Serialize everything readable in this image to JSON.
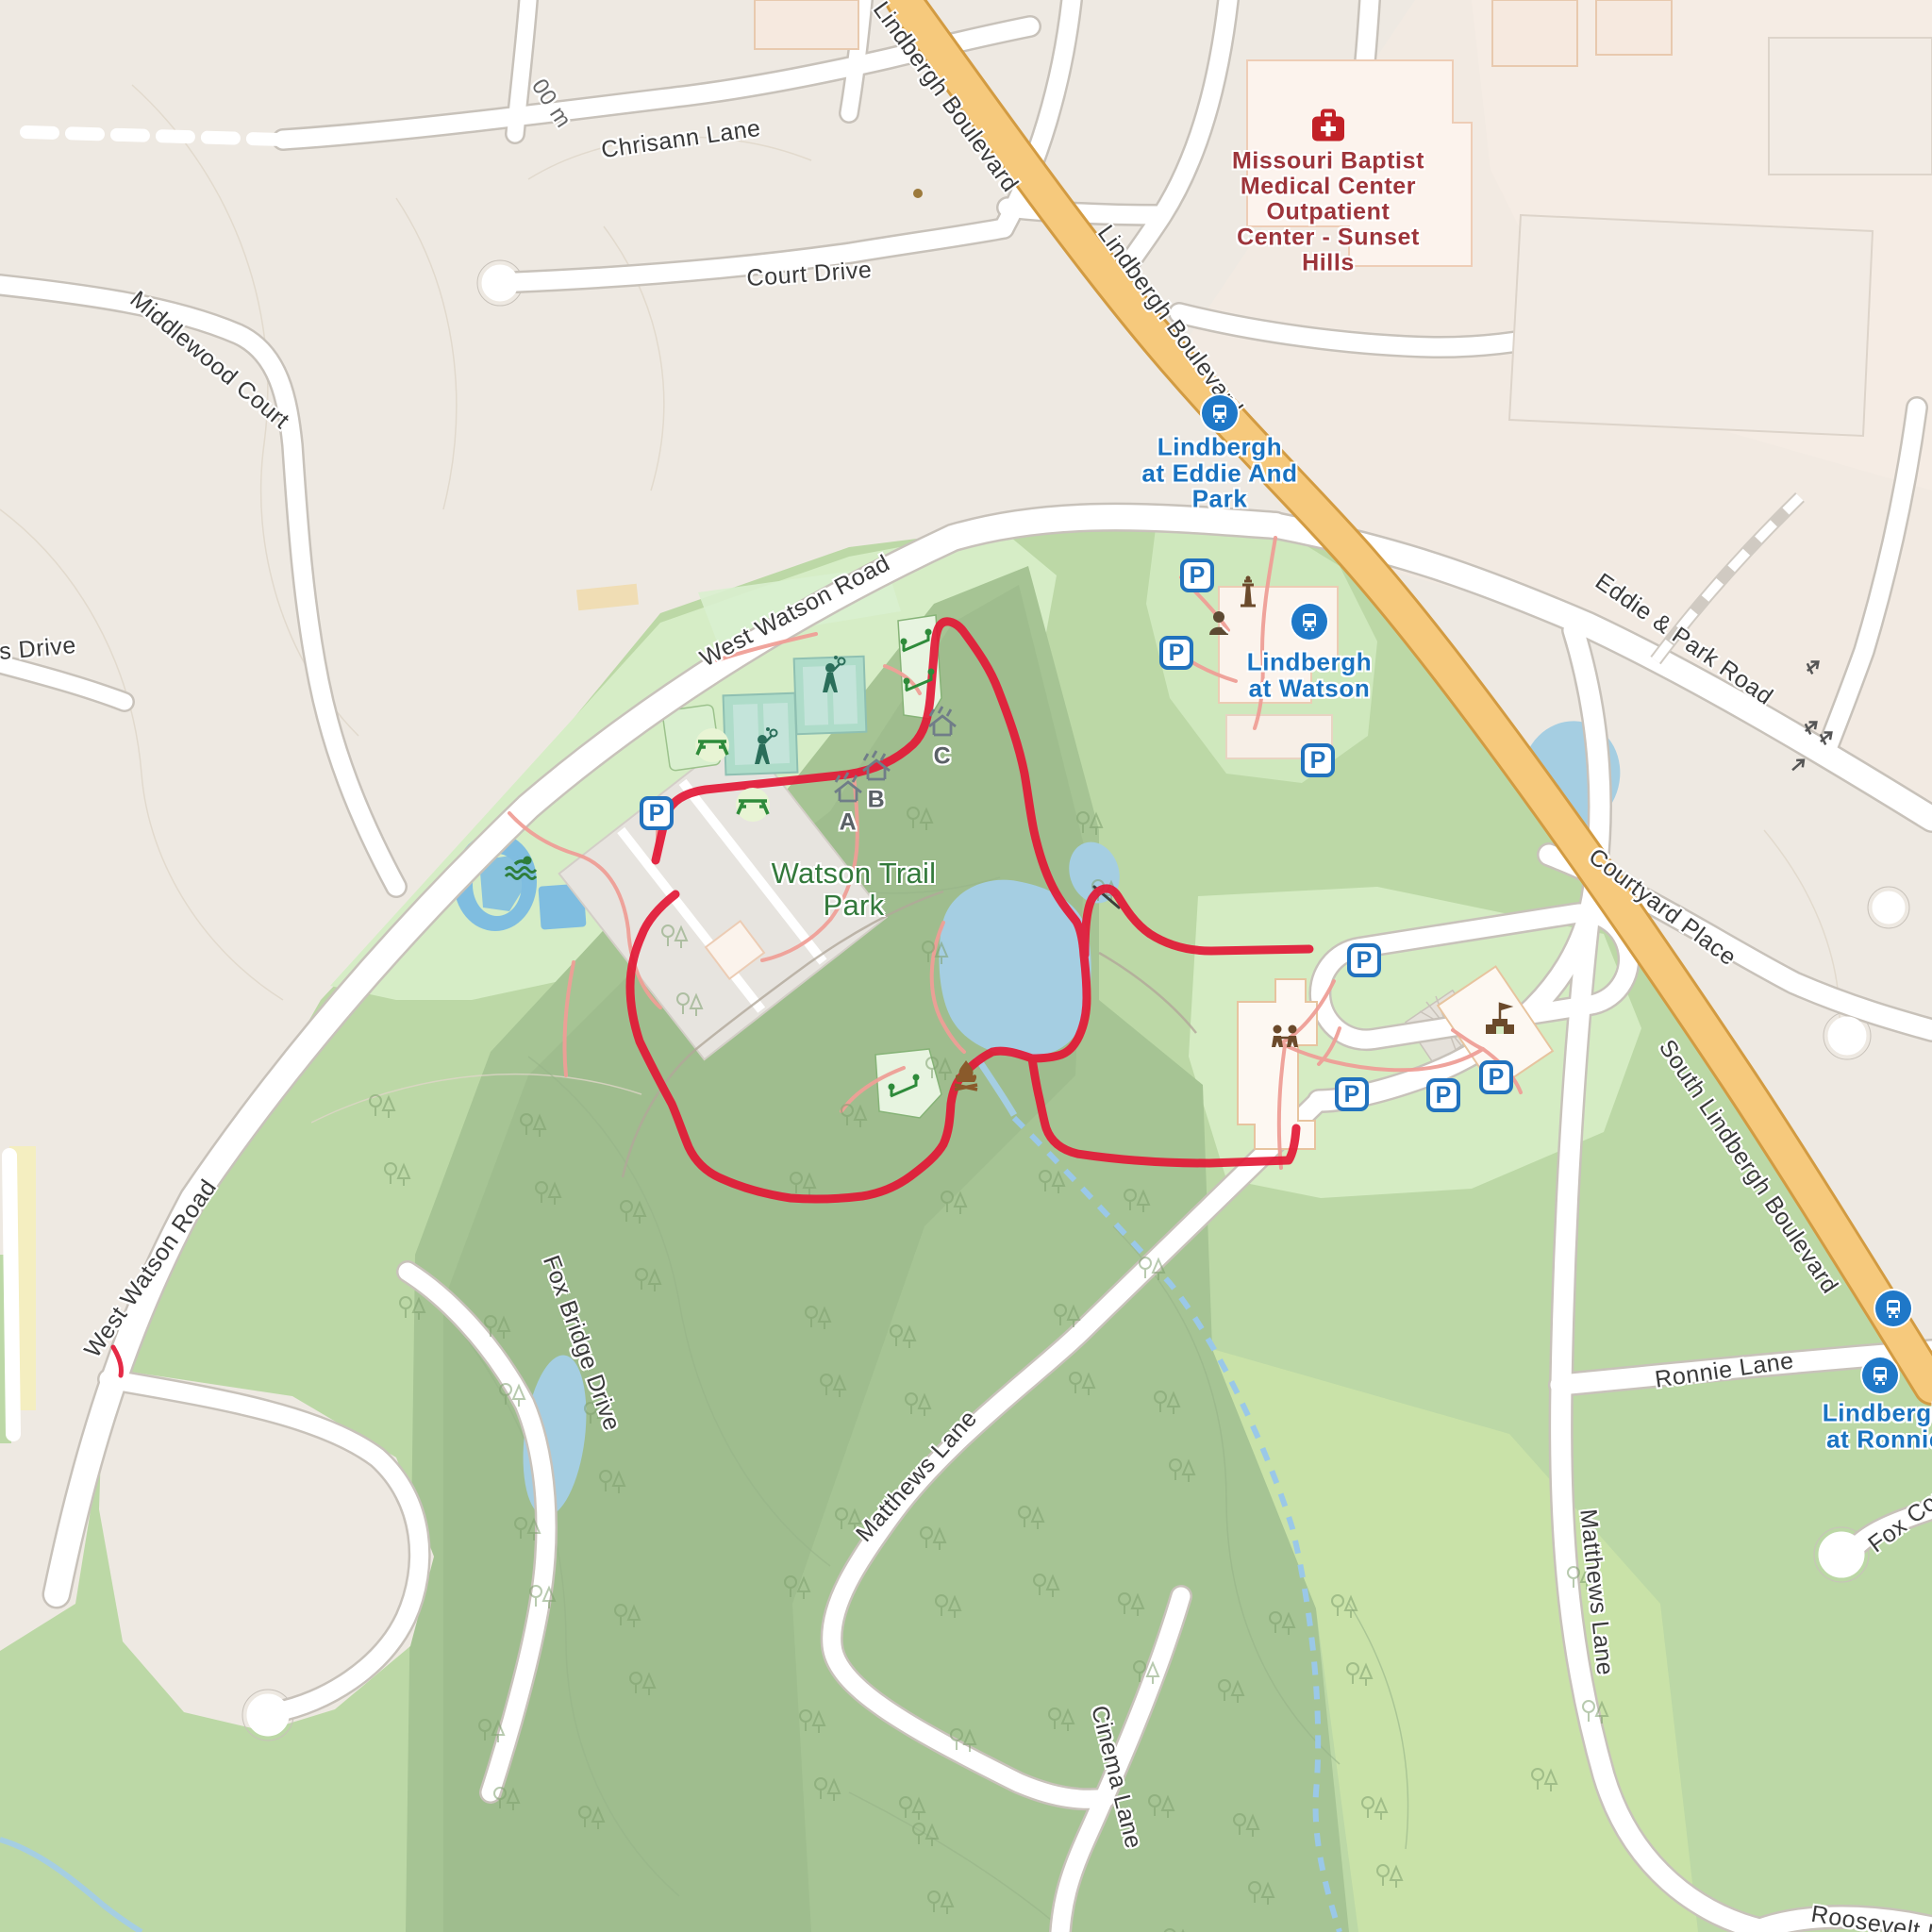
{
  "map_title": "Watson Trail Park area map",
  "road_labels": {
    "chrisann": "Chrisann Lane",
    "court_drive": "Court Drive",
    "middlewood": "Middlewood Court",
    "scale_partial": "00 m",
    "lindbergh_a": "Lindbergh Boulevard",
    "lindbergh_b": "Lindbergh Boulevard",
    "west_watson_a": "West Watson Road",
    "west_watson_b": "West Watson Road",
    "eddie_park": "Eddie & Park Road",
    "courtyard": "Courtyard Place",
    "south_lindbergh": "South Lindbergh Boulevard",
    "ronnie": "Ronnie Lane",
    "fox_bridge": "Fox Bridge Drive",
    "matthews_a": "Matthews Lane",
    "matthews_b": "Matthews Lane",
    "cinema": "Cinema Lane",
    "fox_court": "Fox Court",
    "roosevelt": "Roosevelt Dr",
    "s_drive": "s Drive"
  },
  "pois": {
    "park": {
      "lines": [
        "Watson Trail",
        "Park"
      ]
    },
    "hospital": {
      "lines": [
        "Missouri Baptist",
        "Medical Center",
        "Outpatient",
        "Center - Sunset",
        "Hills"
      ]
    }
  },
  "transit_stops": {
    "eddie": {
      "lines": [
        "Lindbergh",
        "at Eddie And",
        "Park"
      ]
    },
    "watson": {
      "lines": [
        "Lindbergh",
        "at Watson"
      ]
    },
    "ronnie": {
      "lines": [
        "Lindbergh",
        "at Ronnie"
      ]
    }
  },
  "markers": {
    "parking_letter": "P",
    "shelters": [
      "A",
      "B",
      "C"
    ]
  },
  "colors": {
    "route": "#e31836",
    "highway_fill": "#f6c97c",
    "highway_casing": "#d29b42",
    "water": "#a5cee2",
    "transit_blue": "#1a73c1",
    "hospital_red": "#9d353b",
    "park_label_green": "#33793b"
  }
}
